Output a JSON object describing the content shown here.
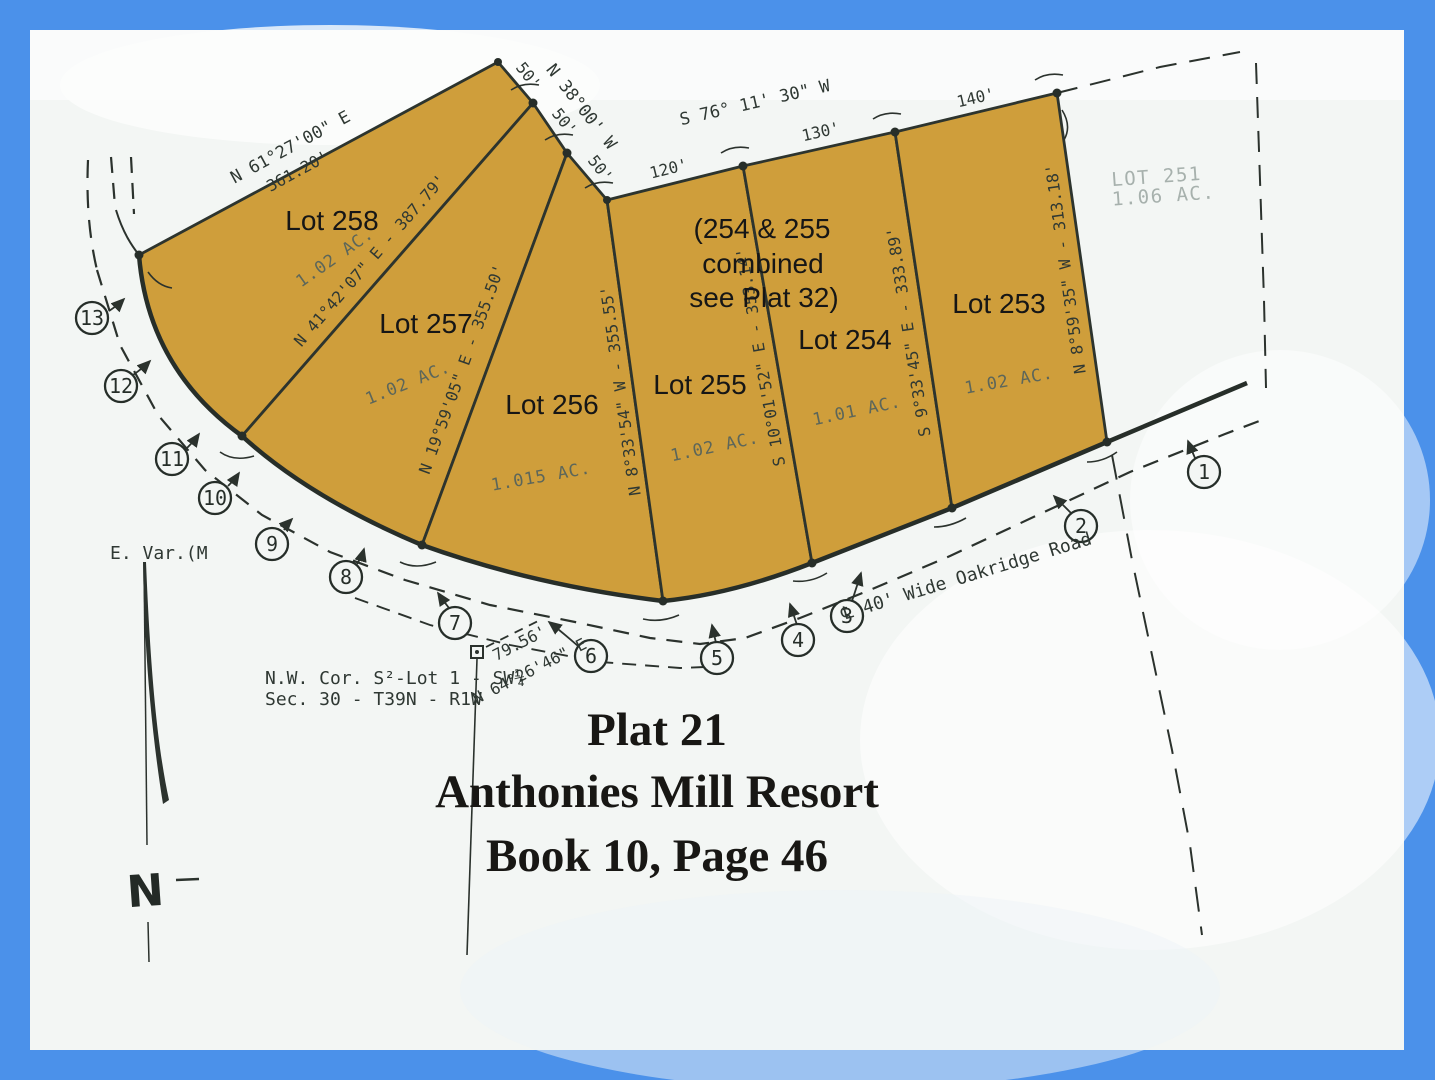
{
  "colors": {
    "frame": "#4b91ea",
    "paper": "#f3f6f4",
    "parcel_fill": "#cf9e3b",
    "ink": "#2b322d",
    "faded_ink": "#5c665a",
    "ghost_text": "#a7b1ad"
  },
  "title": {
    "line1": "Plat 21",
    "line2": "Anthonies Mill Resort",
    "line3": "Book 10, Page 46"
  },
  "lots": [
    {
      "name": "Lot 258",
      "acreage": "1.02 AC."
    },
    {
      "name": "Lot 257",
      "acreage": "1.02 AC."
    },
    {
      "name": "Lot 256",
      "acreage": "1.015 AC."
    },
    {
      "name": "Lot 255",
      "acreage": "1.02 AC."
    },
    {
      "name": "Lot 254",
      "acreage": "1.01 AC."
    },
    {
      "name": "Lot 253",
      "acreage": "1.02 AC."
    }
  ],
  "combined_note": {
    "line1": "(254 & 255",
    "line2": "combined",
    "line3": "see Plat 32)"
  },
  "adjacent_lot": {
    "name": "LOT 251",
    "acreage": "1.06 AC."
  },
  "bearings": {
    "nw_line": "N 61°27'00\" E",
    "nw_dist": "361.20'",
    "n38_line": "N 38°00' W",
    "n38_d1": "50'",
    "n38_d2": "50'",
    "n38_d3": "50'",
    "s76_line": "S 76° 11' 30\" W",
    "d120": "120'",
    "d130": "130'",
    "d140": "140'",
    "lot258_257": "N 41°42'07\" E - 387.79'",
    "lot257_256": "N 19°59'05\" E - 355.50'",
    "lot256_255": "N 8°33'54\" W - 355.55'",
    "lot255_254": "S 10°01'52\" E - 353.14'",
    "lot254_253": "S 9°33'45\" E - 333.89'",
    "lot253_east": "N 8°59'35\" W - 313.18'"
  },
  "road": {
    "centerline_label": "℄ 40' Wide Oakridge Road",
    "tie_distance": "79.56'",
    "tie_bearing": "N 64°26'46\" E"
  },
  "corner_note": {
    "line1": "N.W. Cor. S²-Lot 1 - SW¼",
    "line2": "Sec. 30 - T39N - R1W"
  },
  "east_variation": "E. Var.(M",
  "north_arrow_label": "N",
  "station_markers": [
    "1",
    "2",
    "3",
    "4",
    "5",
    "6",
    "7",
    "8",
    "9",
    "10",
    "11",
    "12",
    "13"
  ]
}
